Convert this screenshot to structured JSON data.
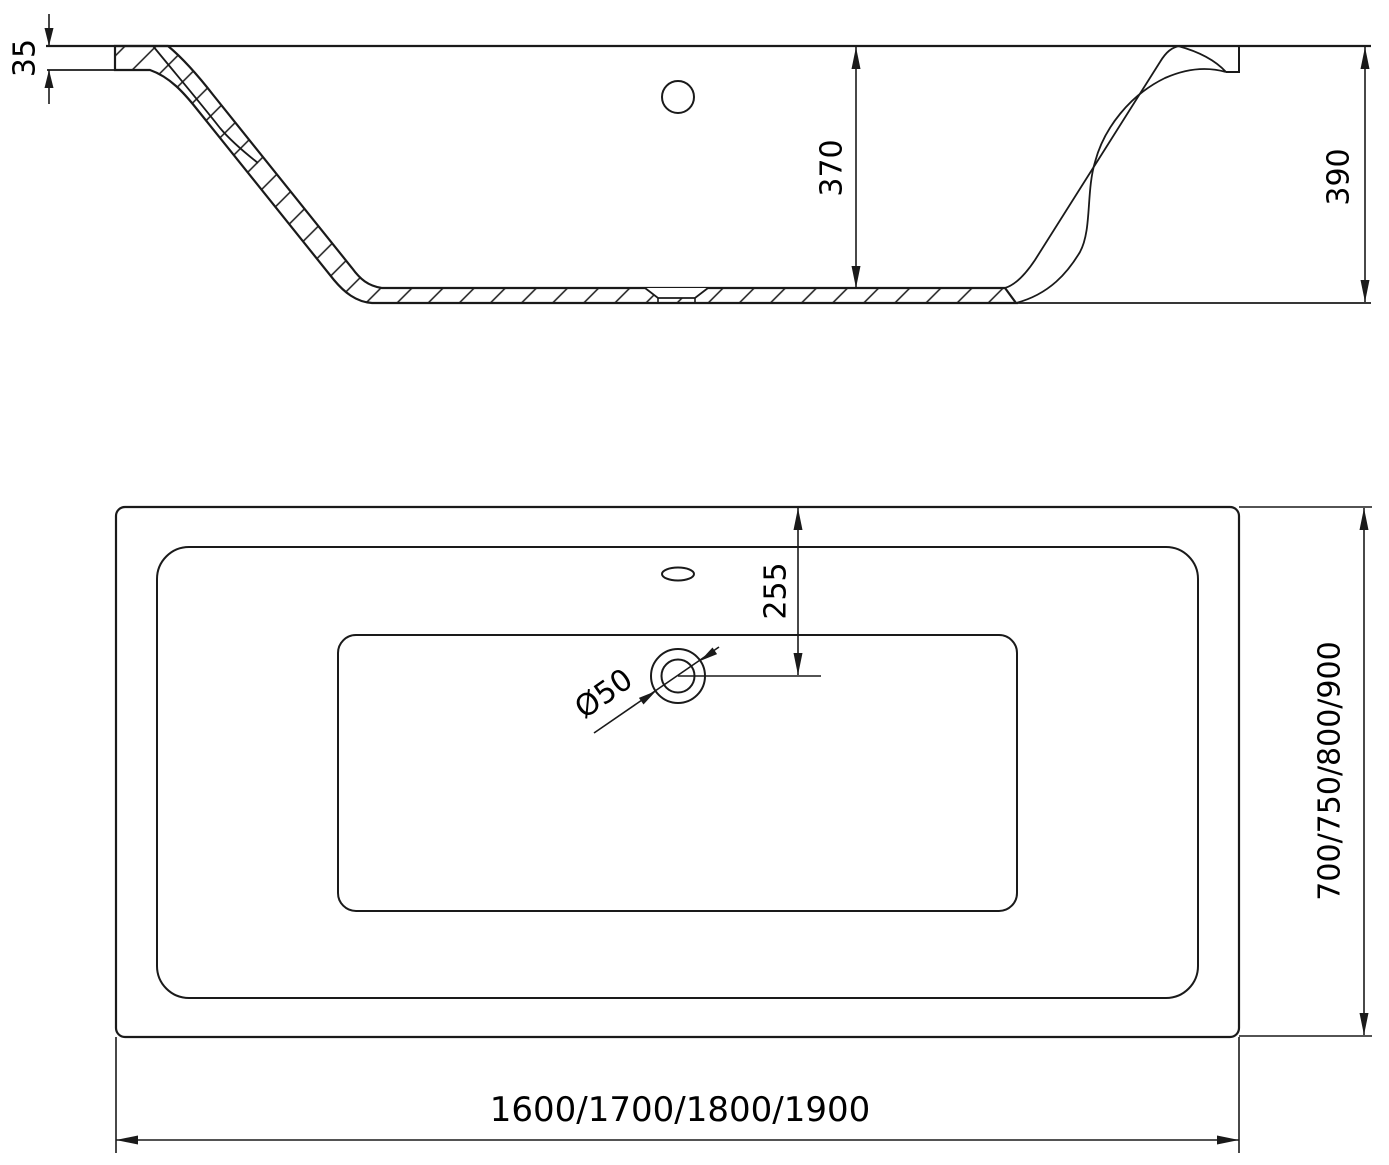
{
  "meta": {
    "background": "#ffffff",
    "line_color": "#1a1a1a",
    "text_color": "#000000",
    "drawing_kind": "bathtub technical drawing, side section view and top plan view"
  },
  "section_view": {
    "labels": {
      "rim_thickness": "35",
      "inner_depth": "370",
      "overall_height": "390"
    }
  },
  "plan_view": {
    "labels": {
      "drain_offset": "255",
      "drain_diameter": "Ø50",
      "width_options": "700/750/800/900",
      "length_options": "1600/1700/1800/1900"
    }
  }
}
